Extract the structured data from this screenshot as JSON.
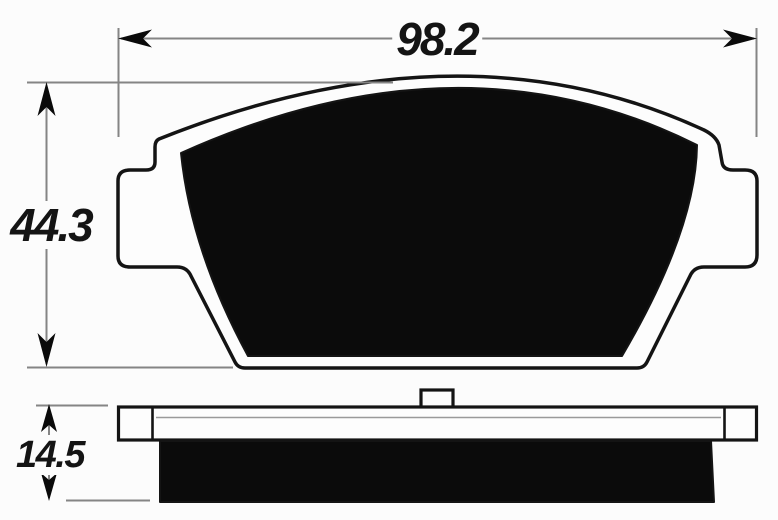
{
  "drawing": {
    "dimensions": {
      "width": {
        "label": "98.2"
      },
      "height": {
        "label": "44.3"
      },
      "thickness": {
        "label": "14.5"
      }
    },
    "colors": {
      "background": "#fcfcfc",
      "outline": "#141414",
      "friction_fill": "#0b0b0b",
      "dimension_line": "#858585",
      "label_text": "#141414"
    }
  }
}
